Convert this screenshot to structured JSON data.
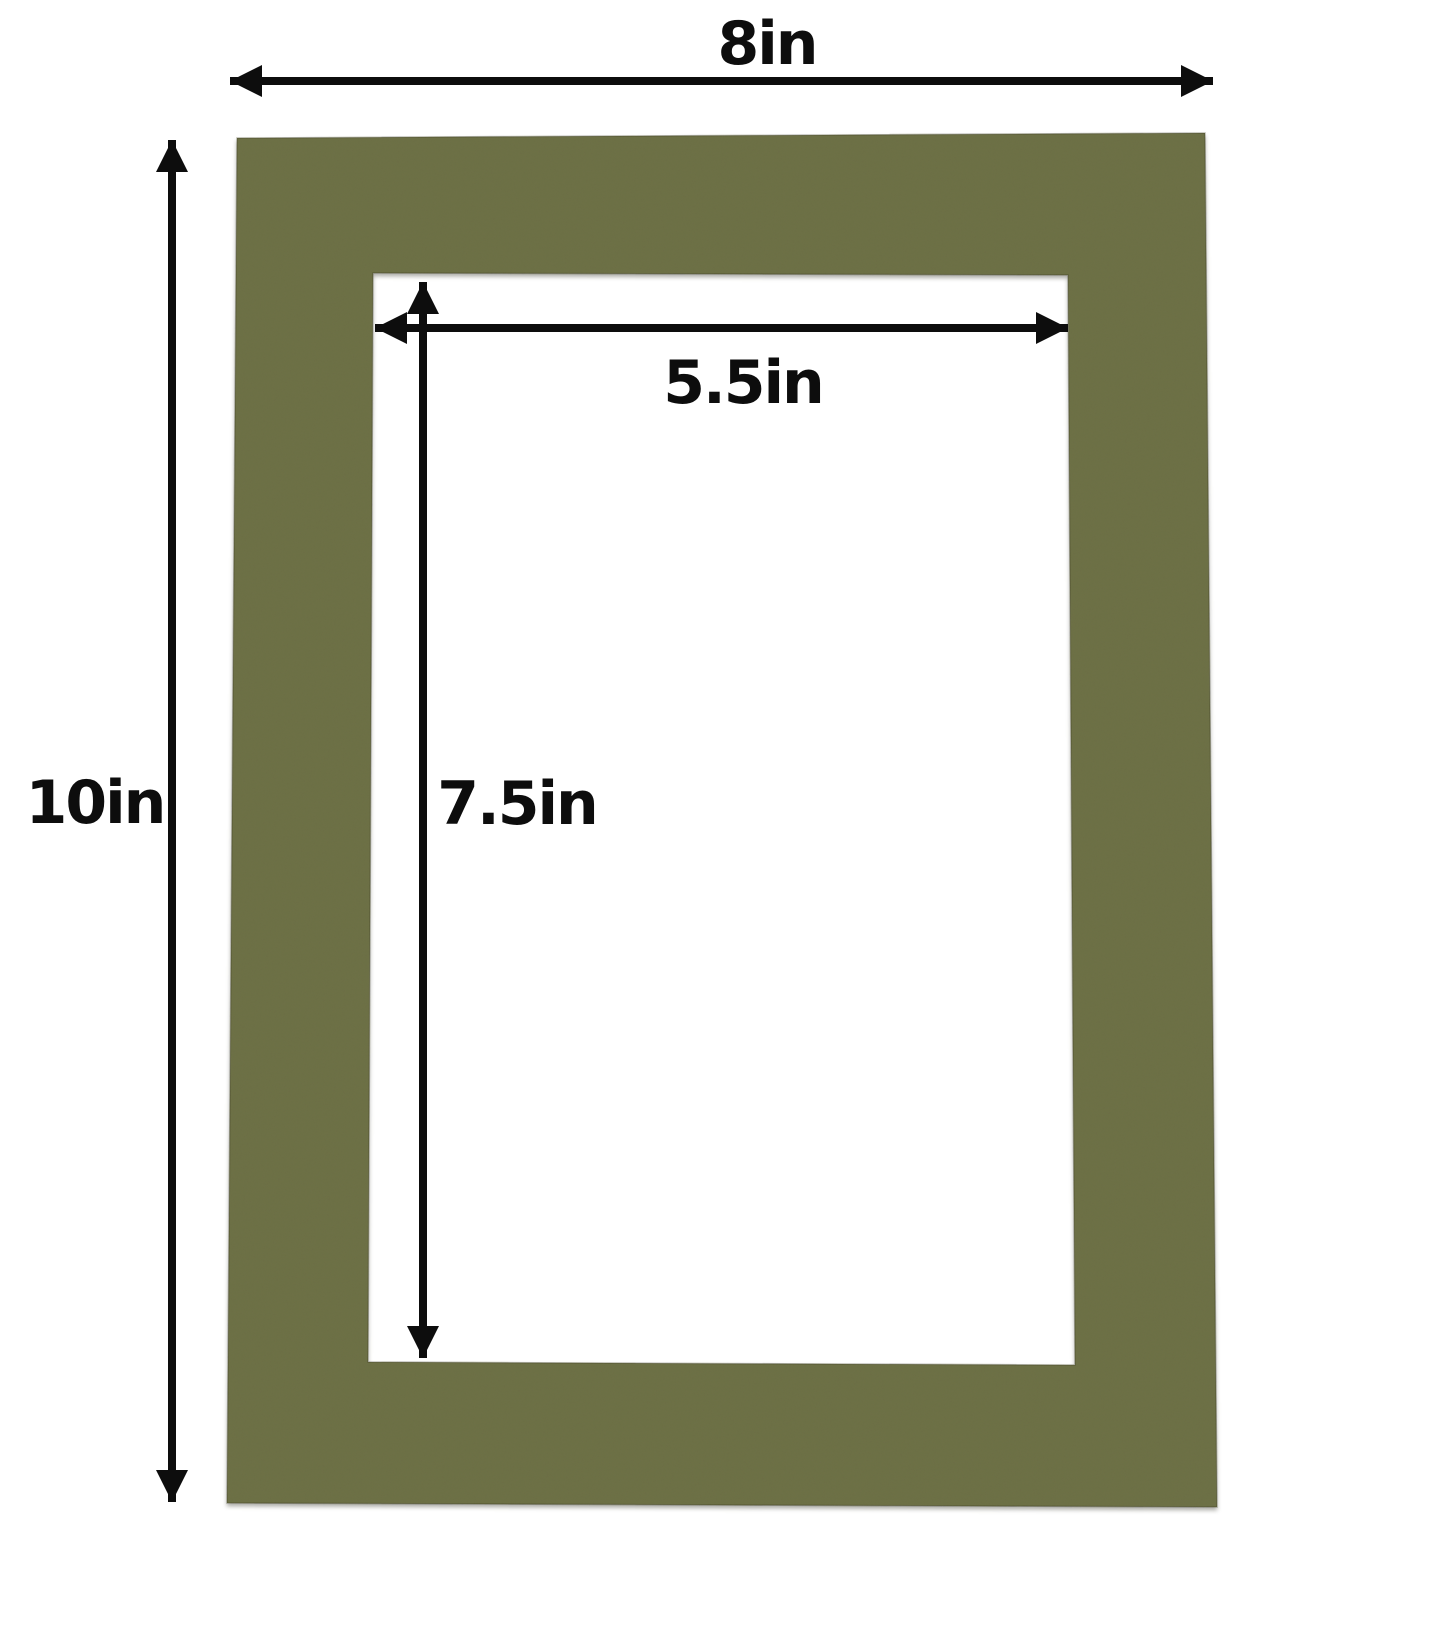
{
  "diagram": {
    "colors": {
      "background": "#ffffff",
      "mat": "#6c6f44",
      "arrow": "#0d0d0d"
    },
    "dimensions": {
      "outer_width": {
        "label": "8in",
        "value": 8,
        "unit": "in"
      },
      "outer_height": {
        "label": "10in",
        "value": 10,
        "unit": "in"
      },
      "opening_width": {
        "label": "5.5in",
        "value": 5.5,
        "unit": "in"
      },
      "opening_height": {
        "label": "7.5in",
        "value": 7.5,
        "unit": "in"
      }
    }
  }
}
